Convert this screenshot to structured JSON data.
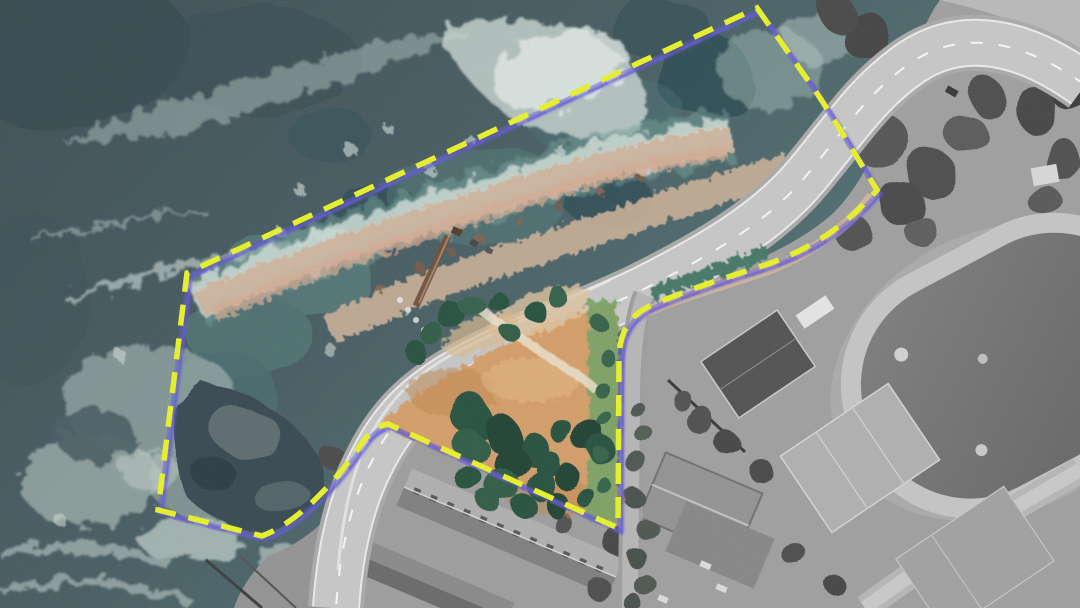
{
  "scene": {
    "type": "aerial-satellite-photograph-with-site-annotation",
    "description": "Top-down aerial photo of a rocky coastal headland: dark ocean with white surf on the left, a curving coastal avenue, a small park with orange ground and dark green trees inside a highlighted site, and desaturated grayscale surroundings (school buildings, tennis courts, athletics track) to the east and south.",
    "visible_text": "none"
  },
  "site_boundary": {
    "shape": "irregular closed polygon drawn over the headland, park and adjacent ocean",
    "line_style": "dashed",
    "dash_color": "#e9f31e",
    "shadow_color": "#5b51d6",
    "dash_pattern": "21 13",
    "stroke_width": "5.5",
    "shadow_width": "3.2",
    "interleave_width": "6",
    "path_d": "M 757 8 L 812 86 C 834 118 856 156 877 190 C 842 230 806 252 756 268 C 718 280 682 292 650 306 C 632 314 620 330 619 356 L 618 528 L 388 424 C 376 426 368 434 360 446 C 338 478 300 522 262 536 L 158 510 L 187 273 Z",
    "vertices_px": [
      [
        757,
        8
      ],
      [
        877,
        190
      ],
      [
        650,
        306
      ],
      [
        619,
        356
      ],
      [
        618,
        528
      ],
      [
        388,
        424
      ],
      [
        262,
        536
      ],
      [
        158,
        510
      ],
      [
        187,
        273
      ]
    ]
  },
  "palette": {
    "ocean_dark": "#34474e",
    "ocean_mid": "#3e555b",
    "ocean_teal": "#4f7474",
    "foam_white": "#dce7e1",
    "foam_soft": "#b3c4be",
    "rock_tan": "#ccb29a",
    "rock_pink": "#d8a88e",
    "dark_rock": "#2e4049",
    "park_dirt": "#d49a62",
    "tree_green": "#1d4936",
    "grass_strip": "#6f9f5f",
    "hedge_teal": "#3c7262",
    "road_gray": "#c6c6c6",
    "road_shoulder": "#a7a7a7",
    "grayscale_land": "#9c9c9c",
    "court_dark": "#4a4a4a",
    "track_ring": "#c4c4c4",
    "track_infield": "#666666",
    "building_roof": "#adadad",
    "pier_brown": "#6b4530"
  },
  "features": [
    {
      "name": "ocean",
      "state": "rough sea with large foam swirls"
    },
    {
      "name": "surf-foam-band",
      "state": "breaking waves along the rocky shoreline"
    },
    {
      "name": "rocky-shoreline",
      "state": "tan and pink rocks inside the site"
    },
    {
      "name": "dark-tidal-rocks",
      "state": "dark wet rocks at lower left inside site"
    },
    {
      "name": "pier-ramp",
      "state": "narrow brown ramp running from road down to the water"
    },
    {
      "name": "coastal-avenue",
      "state": "light gray multi-lane road curving from top right to bottom"
    },
    {
      "name": "south-street",
      "state": "gray street with street trees heading south east of the park"
    },
    {
      "name": "pocket-park",
      "state": "orange dirt park with dark green tree clusters and a light footpath"
    },
    {
      "name": "grass-strip",
      "state": "green verge along east edge of park"
    },
    {
      "name": "athletics-track",
      "state": "grayscale oval running track with dark infield, right edge"
    },
    {
      "name": "tennis-courts",
      "state": "grayscale courts, one dark court and lighter marked courts"
    },
    {
      "name": "school-buildings",
      "state": "grayscale long pitched-roof buildings at bottom center"
    },
    {
      "name": "coastal-scrub",
      "state": "dark gray vegetation east of the road"
    }
  ]
}
